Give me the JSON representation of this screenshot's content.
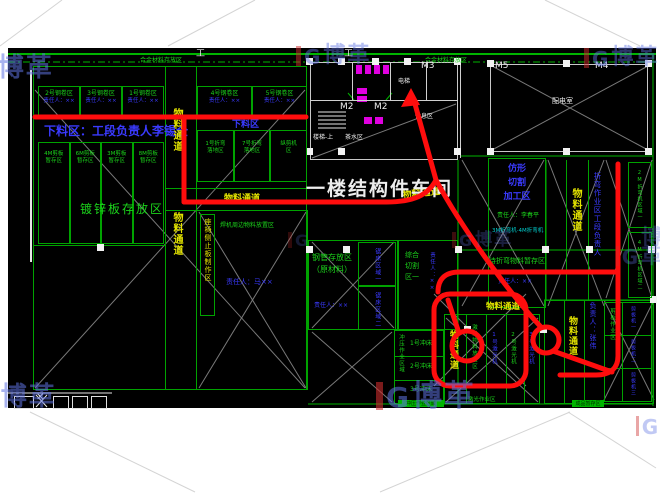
{
  "watermark": {
    "brand": "博革"
  },
  "plan": {
    "title": "一楼结构件车间",
    "corridor": "物料通道",
    "top_wall": {
      "left_label": "合金材料存放区",
      "right_label": "合金材料存放区"
    },
    "doors": {
      "m2_left": "M2",
      "m2_right": "M2",
      "m3": "M3",
      "m5": "M5",
      "m4": "M4"
    },
    "rooms": {
      "power": "配电室",
      "elevator": "电梯",
      "rest": "休息区",
      "stairs": "楼梯-上",
      "tea": "茶水区"
    },
    "symbols": {
      "beam": "工",
      "x_mark": "✕"
    },
    "areas": {
      "banner": "下料区：工段负责人李锡全",
      "blanking_small": "下料区",
      "coil_left": [
        {
          "name": "2号钢卷区",
          "owner": "责任人：××"
        },
        {
          "name": "3号钢卷区",
          "owner": "责任人：××"
        },
        {
          "name": "1号钢卷区",
          "owner": "责任人：××"
        }
      ],
      "coil_right": [
        {
          "name": "4号钢卷区",
          "owner": "责任人：××"
        },
        {
          "name": "5号钢卷区",
          "owner": "责任人：××"
        }
      ],
      "shear_left": [
        {
          "l1": "4M剪板",
          "l2": "暂存区"
        },
        {
          "l1": "6M剪板",
          "l2": "暂存区"
        },
        {
          "l1": "3M剪板",
          "l2": "暂存区"
        },
        {
          "l1": "8M剪板",
          "l2": "暂存区"
        }
      ],
      "bend_row": [
        {
          "l1": "1号折弯",
          "l2": "落地区"
        },
        {
          "l1": "7号折弯",
          "l2": "落地区"
        },
        {
          "l1": "纵剪机",
          "l2": "区"
        }
      ],
      "galvanized": "镀锌板存放区",
      "seat_strip": "座椅侧止板制作区",
      "welder_material": "焊机周边物料放置区",
      "welder_owner": "责任人：马××",
      "pipe1": "钢管存放区",
      "pipe2": "（原材料）",
      "pipe_owner": "责任人：××",
      "saw": [
        "锯床区域一",
        "锯床区域二"
      ],
      "cut": [
        "综合",
        "切割",
        "区一"
      ],
      "cut_owner": "责任人：××",
      "punch_zone": "冲压作业区域",
      "punch": [
        "1号冲床",
        "2号冲床",
        "3号冲床"
      ],
      "punch_bar": "冲压作业区域",
      "laser": [
        "激光物料放置区",
        "1号激光机",
        "2号激光机",
        "3号激光机"
      ],
      "laser_bottom": "激光作业区",
      "finished_bar": "成品暂存区",
      "profiling": [
        "仿形",
        "切割",
        "加工区"
      ],
      "profiling_owner": "责任人：李春平",
      "profiling_note": "3M折弯机·4M折弯机",
      "pre_bend": "待折弯物料暂存区",
      "pre_bend_owner": "责任人：××",
      "bend_section": "折弯作业区工段负责人",
      "bend_right": [
        "2M折弯机区域一",
        "4M折弯机区域二"
      ],
      "shear_right_label": "剪板作业区",
      "shear_right_owner": "负责人：张伟",
      "shear_right": [
        "剪板机一",
        "剪板机二",
        "剪板机三"
      ]
    }
  }
}
